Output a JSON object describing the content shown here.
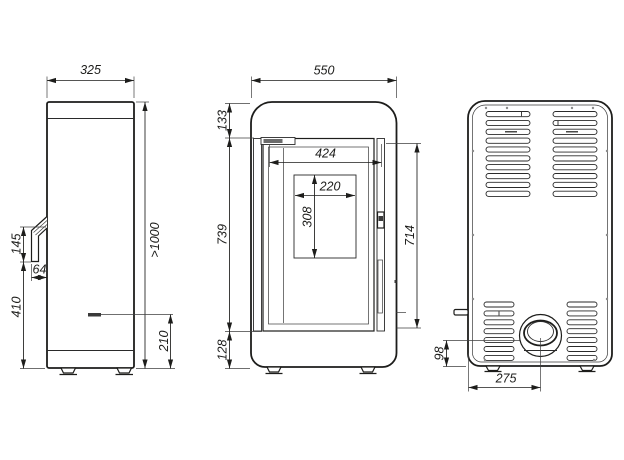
{
  "colors": {
    "line": "#1d1d1b",
    "background": "#ffffff",
    "detail_dark": "#3a3a3a"
  },
  "views": {
    "side": {
      "depth": "325",
      "handle_height": "145",
      "handle_depth": "64",
      "handle_base_height": "410",
      "clearance_height": ">1000",
      "inlet_height": "210"
    },
    "front": {
      "width": "550",
      "top_to_door": "133",
      "door_width": "424",
      "glass_width": "220",
      "glass_height": "308",
      "door_height": "739",
      "door_span": "714",
      "bottom_to_door": "128"
    },
    "back": {
      "flue_center_height": "98",
      "flue_center_offset": "275"
    }
  }
}
